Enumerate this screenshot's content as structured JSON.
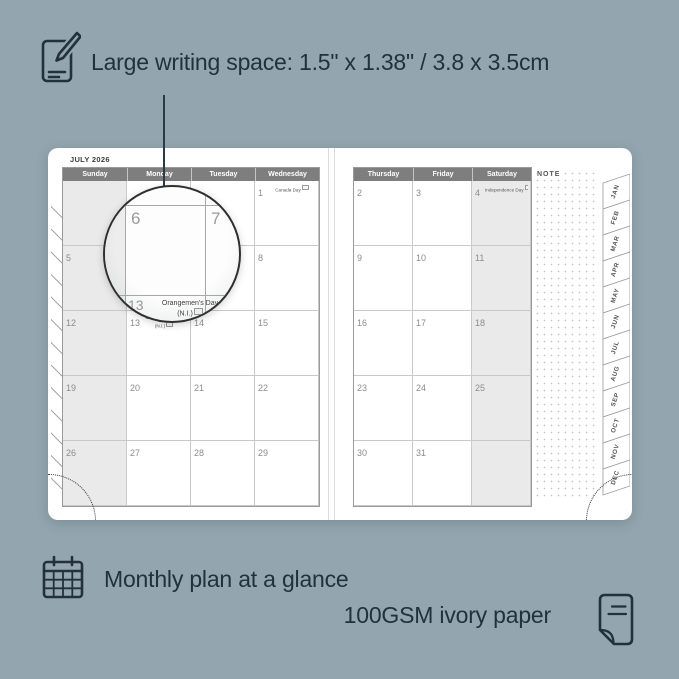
{
  "colors": {
    "background": "#93a6b0",
    "ink": "#22313b",
    "header_bar": "#7e7e7e",
    "weekend_fill": "#eaeaea"
  },
  "annotations": {
    "writing_space": {
      "icon": "pencil-note-icon",
      "text": "Large writing space: 1.5\" x 1.38\" / 3.8 x 3.5cm"
    },
    "monthly_plan": {
      "icon": "calendar-grid-icon",
      "text": "Monthly plan at a glance"
    },
    "paper": {
      "icon": "paper-sheet-icon",
      "text": "100GSM ivory paper"
    }
  },
  "planner": {
    "month_title": "JULY 2026",
    "note_label": "NOTE",
    "left_page": {
      "day_headers": [
        "Sunday",
        "Monday",
        "Tuesday",
        "Wednesday"
      ],
      "weeks": [
        [
          {
            "day": ""
          },
          {
            "day": ""
          },
          {
            "day": ""
          },
          {
            "day": "1",
            "holiday": "Canada Day",
            "badge": true
          }
        ],
        [
          {
            "day": "5"
          },
          {
            "day": "6"
          },
          {
            "day": "7"
          },
          {
            "day": "8"
          }
        ],
        [
          {
            "day": "12"
          },
          {
            "day": "13",
            "holiday": "Orangemen's Day",
            "holiday2": "(N.I.)",
            "badge": true
          },
          {
            "day": "14"
          },
          {
            "day": "15"
          }
        ],
        [
          {
            "day": "19"
          },
          {
            "day": "20"
          },
          {
            "day": "21"
          },
          {
            "day": "22"
          }
        ],
        [
          {
            "day": "26"
          },
          {
            "day": "27"
          },
          {
            "day": "28"
          },
          {
            "day": "29"
          }
        ]
      ]
    },
    "right_page": {
      "day_headers": [
        "Thursday",
        "Friday",
        "Saturday"
      ],
      "weeks": [
        [
          {
            "day": "2"
          },
          {
            "day": "3"
          },
          {
            "day": "4",
            "holiday": "Independence Day",
            "badge": true
          }
        ],
        [
          {
            "day": "9"
          },
          {
            "day": "10"
          },
          {
            "day": "11"
          }
        ],
        [
          {
            "day": "16"
          },
          {
            "day": "17"
          },
          {
            "day": "18"
          }
        ],
        [
          {
            "day": "23"
          },
          {
            "day": "24"
          },
          {
            "day": "25"
          }
        ],
        [
          {
            "day": "30"
          },
          {
            "day": "31"
          },
          {
            "day": ""
          }
        ]
      ]
    },
    "month_tabs": [
      "JAN",
      "FEB",
      "MAR",
      "APR",
      "MAY",
      "JUN",
      "JUL",
      "AUG",
      "SEP",
      "OCT",
      "NOV",
      "DEC"
    ]
  },
  "magnifier": {
    "large_day": "6",
    "next_day": "7",
    "below_day": "13",
    "holiday_line1": "Orangemen's Day",
    "holiday_line2": "(N.I.)"
  }
}
